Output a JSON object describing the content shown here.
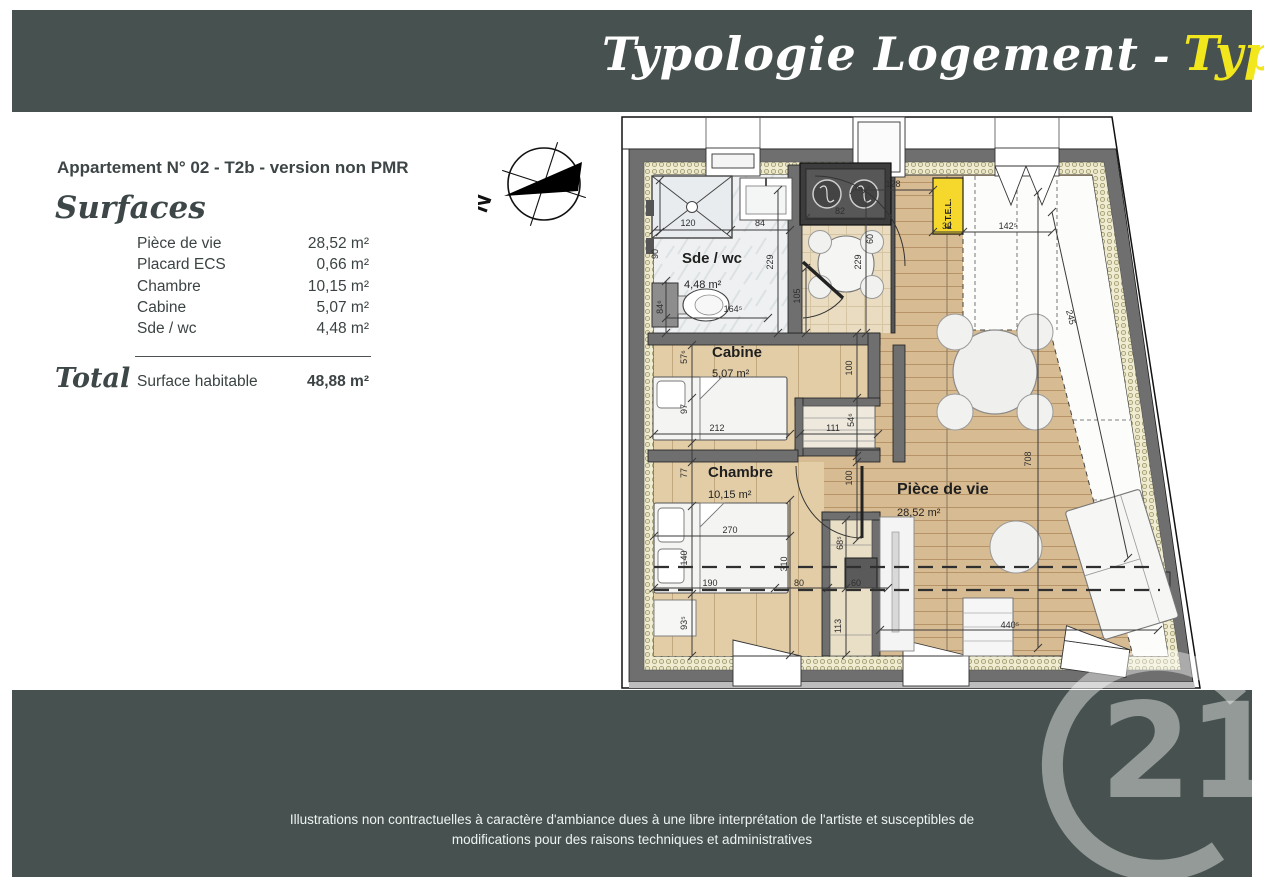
{
  "header": {
    "title": "Typologie Logement",
    "separator": "-",
    "type_label": "Type 2b"
  },
  "info_panel": {
    "apartment_title": "Appartement N° 02 - T2b - version non PMR",
    "section_heading": "Surfaces",
    "surface_rows": [
      {
        "label": "Pièce de vie",
        "value": "28,52 m²"
      },
      {
        "label": "Placard ECS",
        "value": "0,66 m²"
      },
      {
        "label": "Chambre",
        "value": "10,15 m²"
      },
      {
        "label": "Cabine",
        "value": "5,07 m²"
      },
      {
        "label": "Sde / wc",
        "value": "4,48 m²"
      }
    ],
    "total_heading": "Total",
    "total_label": "Surface habitable",
    "total_value": "48,88 m²"
  },
  "compass": {
    "north_label": "N"
  },
  "floor_plan": {
    "rooms": [
      {
        "name": "Sde / wc",
        "area": "4,48 m²"
      },
      {
        "name": "Cabine",
        "area": "5,07 m²"
      },
      {
        "name": "Chambre",
        "area": "10,15 m²"
      },
      {
        "name": "Pièce de vie",
        "area": "28,52 m²"
      }
    ],
    "etel_label": "E.T.E.L.",
    "dims": [
      "120",
      "84",
      "90",
      "84⁶",
      "229",
      "164⁵",
      "82",
      "60",
      "105",
      "128",
      "32",
      "142⁵",
      "229",
      "245",
      "57⁶",
      "97",
      "212",
      "111",
      "54⁶",
      "100",
      "100",
      "77",
      "270",
      "140",
      "310",
      "68⁵",
      "190",
      "80",
      "60",
      "113",
      "93⁵",
      "440⁵",
      "708"
    ]
  },
  "footer": {
    "disclaimer_line1": "Illustrations non contractuelles à caractère d'ambiance dues à une libre interprétation de l'artiste et susceptibles de",
    "disclaimer_line2": "modifications pour des raisons techniques et administratives",
    "logo_number": "21"
  },
  "colors": {
    "band": "#47514f",
    "title_accent": "#f2e71d",
    "etel_yellow": "#f6d72c"
  }
}
